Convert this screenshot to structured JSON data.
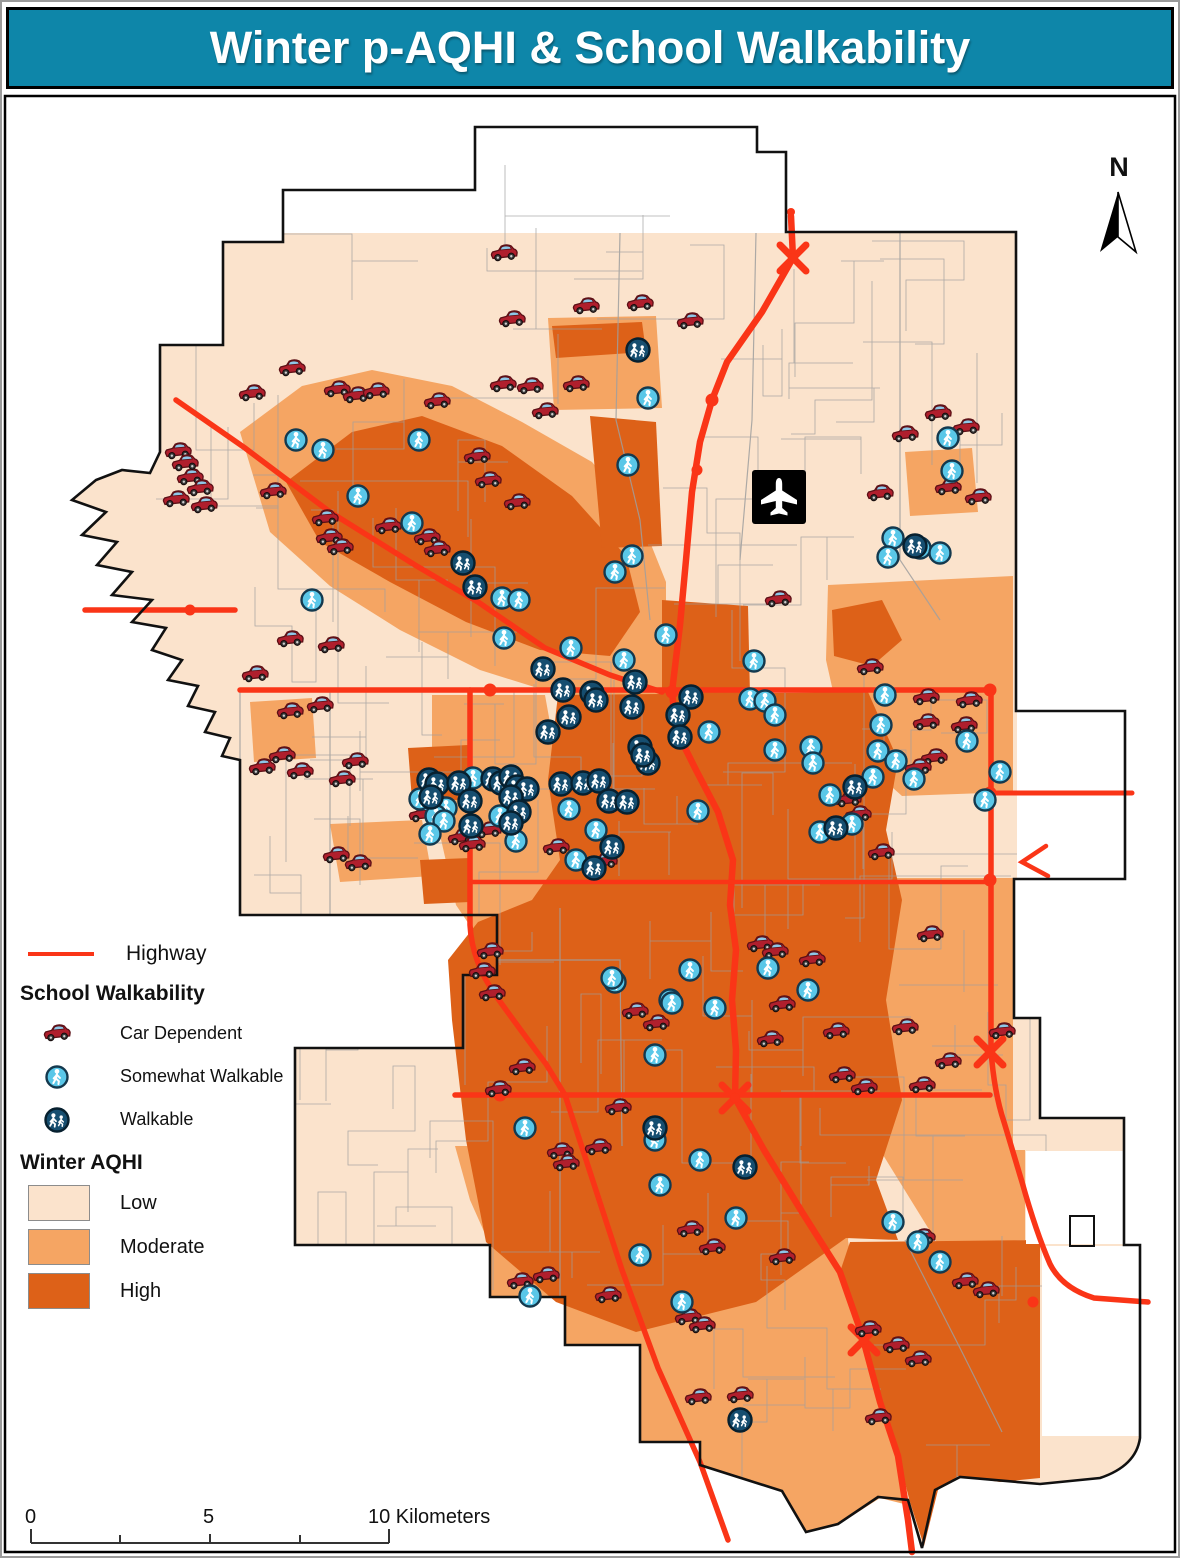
{
  "title": "Winter p-AQHI & School Walkability",
  "north": {
    "label": "N",
    "icon": "north-arrow-icon"
  },
  "airport": {
    "icon": "airplane-icon"
  },
  "legend": {
    "highway": {
      "label": "Highway",
      "color": "#fa3517",
      "icon": "highway-line-sample"
    },
    "school_walkability_heading": "School Walkability",
    "items": [
      {
        "label": "Car Dependent",
        "icon": "car-icon"
      },
      {
        "label": "Somewhat Walkable",
        "icon": "somewhat-walkable-icon"
      },
      {
        "label": "Walkable",
        "icon": "walkable-icon"
      }
    ],
    "aqhi_heading": "Winter AQHI",
    "aqhi_classes": [
      {
        "label": "Low",
        "color": "#fbe3cc"
      },
      {
        "label": "Moderate",
        "color": "#f5a563"
      },
      {
        "label": "High",
        "color": "#dd6118"
      }
    ]
  },
  "scale_bar": {
    "labels": [
      "0",
      "5",
      "10 Kilometers"
    ]
  },
  "colors": {
    "title_bg": "#0e86a9",
    "aqhi_low": "#fbe3cc",
    "aqhi_moderate": "#f5a563",
    "aqhi_high": "#dd6118",
    "highway": "#fa3517",
    "boundary": "#111111",
    "walkable_marker": "#164e70",
    "somewhat_marker": "#5ac7e8",
    "car_marker": "#b01f2d"
  },
  "map": {
    "markers": {
      "car": [
        [
          504,
          254
        ],
        [
          586,
          307
        ],
        [
          512,
          320
        ],
        [
          640,
          304
        ],
        [
          690,
          322
        ],
        [
          292,
          369
        ],
        [
          252,
          394
        ],
        [
          337,
          390
        ],
        [
          356,
          396
        ],
        [
          376,
          392
        ],
        [
          437,
          402
        ],
        [
          545,
          412
        ],
        [
          576,
          385
        ],
        [
          503,
          385
        ],
        [
          530,
          387
        ],
        [
          938,
          414
        ],
        [
          966,
          428
        ],
        [
          905,
          435
        ],
        [
          880,
          494
        ],
        [
          948,
          488
        ],
        [
          978,
          498
        ],
        [
          178,
          452
        ],
        [
          190,
          478
        ],
        [
          176,
          500
        ],
        [
          185,
          464
        ],
        [
          200,
          489
        ],
        [
          204,
          506
        ],
        [
          273,
          492
        ],
        [
          325,
          519
        ],
        [
          329,
          538
        ],
        [
          340,
          548
        ],
        [
          388,
          527
        ],
        [
          427,
          538
        ],
        [
          437,
          550
        ],
        [
          477,
          457
        ],
        [
          488,
          481
        ],
        [
          517,
          503
        ],
        [
          290,
          640
        ],
        [
          331,
          646
        ],
        [
          255,
          675
        ],
        [
          290,
          712
        ],
        [
          320,
          706
        ],
        [
          282,
          756
        ],
        [
          262,
          768
        ],
        [
          300,
          772
        ],
        [
          355,
          762
        ],
        [
          342,
          780
        ],
        [
          336,
          856
        ],
        [
          358,
          864
        ],
        [
          422,
          815
        ],
        [
          461,
          838
        ],
        [
          472,
          845
        ],
        [
          488,
          831
        ],
        [
          556,
          848
        ],
        [
          604,
          862
        ],
        [
          778,
          600
        ],
        [
          870,
          668
        ],
        [
          926,
          698
        ],
        [
          969,
          701
        ],
        [
          926,
          723
        ],
        [
          964,
          726
        ],
        [
          934,
          758
        ],
        [
          918,
          768
        ],
        [
          848,
          800
        ],
        [
          858,
          815
        ],
        [
          881,
          853
        ],
        [
          760,
          945
        ],
        [
          775,
          952
        ],
        [
          490,
          952
        ],
        [
          482,
          972
        ],
        [
          492,
          994
        ],
        [
          522,
          1068
        ],
        [
          498,
          1090
        ],
        [
          618,
          1108
        ],
        [
          560,
          1152
        ],
        [
          598,
          1148
        ],
        [
          566,
          1164
        ],
        [
          635,
          1012
        ],
        [
          656,
          1024
        ],
        [
          770,
          1040
        ],
        [
          812,
          960
        ],
        [
          782,
          1005
        ],
        [
          836,
          1032
        ],
        [
          905,
          1028
        ],
        [
          948,
          1062
        ],
        [
          922,
          1086
        ],
        [
          842,
          1076
        ],
        [
          864,
          1088
        ],
        [
          930,
          935
        ],
        [
          1002,
          1032
        ],
        [
          922,
          1238
        ],
        [
          690,
          1230
        ],
        [
          712,
          1248
        ],
        [
          782,
          1258
        ],
        [
          608,
          1296
        ],
        [
          688,
          1318
        ],
        [
          702,
          1326
        ],
        [
          520,
          1282
        ],
        [
          546,
          1276
        ],
        [
          965,
          1282
        ],
        [
          986,
          1291
        ],
        [
          868,
          1330
        ],
        [
          896,
          1346
        ],
        [
          918,
          1360
        ],
        [
          698,
          1398
        ],
        [
          740,
          1396
        ],
        [
          878,
          1418
        ]
      ],
      "somewhat": [
        [
          648,
          398
        ],
        [
          948,
          438
        ],
        [
          952,
          471
        ],
        [
          893,
          538
        ],
        [
          920,
          548
        ],
        [
          940,
          553
        ],
        [
          888,
          557
        ],
        [
          296,
          440
        ],
        [
          323,
          450
        ],
        [
          419,
          440
        ],
        [
          358,
          496
        ],
        [
          412,
          523
        ],
        [
          628,
          465
        ],
        [
          632,
          556
        ],
        [
          615,
          572
        ],
        [
          502,
          598
        ],
        [
          519,
          600
        ],
        [
          504,
          638
        ],
        [
          312,
          600
        ],
        [
          885,
          695
        ],
        [
          881,
          725
        ],
        [
          967,
          741
        ],
        [
          878,
          751
        ],
        [
          896,
          761
        ],
        [
          873,
          777
        ],
        [
          914,
          779
        ],
        [
          852,
          824
        ],
        [
          985,
          800
        ],
        [
          1000,
          772
        ],
        [
          473,
          778
        ],
        [
          420,
          799
        ],
        [
          438,
          806
        ],
        [
          446,
          808
        ],
        [
          436,
          816
        ],
        [
          444,
          821
        ],
        [
          430,
          834
        ],
        [
          500,
          816
        ],
        [
          516,
          841
        ],
        [
          571,
          648
        ],
        [
          624,
          660
        ],
        [
          666,
          635
        ],
        [
          754,
          661
        ],
        [
          750,
          699
        ],
        [
          765,
          701
        ],
        [
          775,
          715
        ],
        [
          709,
          732
        ],
        [
          775,
          750
        ],
        [
          811,
          747
        ],
        [
          813,
          763
        ],
        [
          569,
          809
        ],
        [
          596,
          830
        ],
        [
          576,
          860
        ],
        [
          698,
          811
        ],
        [
          830,
          795
        ],
        [
          820,
          832
        ],
        [
          768,
          968
        ],
        [
          808,
          990
        ],
        [
          670,
          1000
        ],
        [
          615,
          982
        ],
        [
          690,
          970
        ],
        [
          715,
          1008
        ],
        [
          672,
          1003
        ],
        [
          655,
          1055
        ],
        [
          525,
          1128
        ],
        [
          655,
          1140
        ],
        [
          700,
          1160
        ],
        [
          736,
          1218
        ],
        [
          660,
          1185
        ],
        [
          640,
          1255
        ],
        [
          682,
          1302
        ],
        [
          530,
          1296
        ],
        [
          893,
          1222
        ],
        [
          918,
          1242
        ],
        [
          940,
          1262
        ],
        [
          612,
          978
        ]
      ],
      "walkable": [
        [
          638,
          350
        ],
        [
          915,
          546
        ],
        [
          463,
          563
        ],
        [
          475,
          587
        ],
        [
          429,
          780
        ],
        [
          437,
          784
        ],
        [
          459,
          783
        ],
        [
          431,
          797
        ],
        [
          470,
          801
        ],
        [
          471,
          826
        ],
        [
          493,
          779
        ],
        [
          501,
          783
        ],
        [
          511,
          777
        ],
        [
          517,
          787
        ],
        [
          527,
          789
        ],
        [
          511,
          797
        ],
        [
          519,
          812
        ],
        [
          511,
          823
        ],
        [
          543,
          669
        ],
        [
          563,
          690
        ],
        [
          592,
          693
        ],
        [
          635,
          682
        ],
        [
          596,
          700
        ],
        [
          632,
          707
        ],
        [
          691,
          697
        ],
        [
          678,
          715
        ],
        [
          680,
          737
        ],
        [
          648,
          763
        ],
        [
          569,
          717
        ],
        [
          548,
          732
        ],
        [
          640,
          747
        ],
        [
          643,
          755
        ],
        [
          561,
          784
        ],
        [
          583,
          783
        ],
        [
          599,
          781
        ],
        [
          609,
          801
        ],
        [
          627,
          802
        ],
        [
          612,
          847
        ],
        [
          594,
          868
        ],
        [
          855,
          787
        ],
        [
          836,
          828
        ],
        [
          745,
          1167
        ],
        [
          655,
          1128
        ],
        [
          740,
          1420
        ]
      ]
    }
  }
}
